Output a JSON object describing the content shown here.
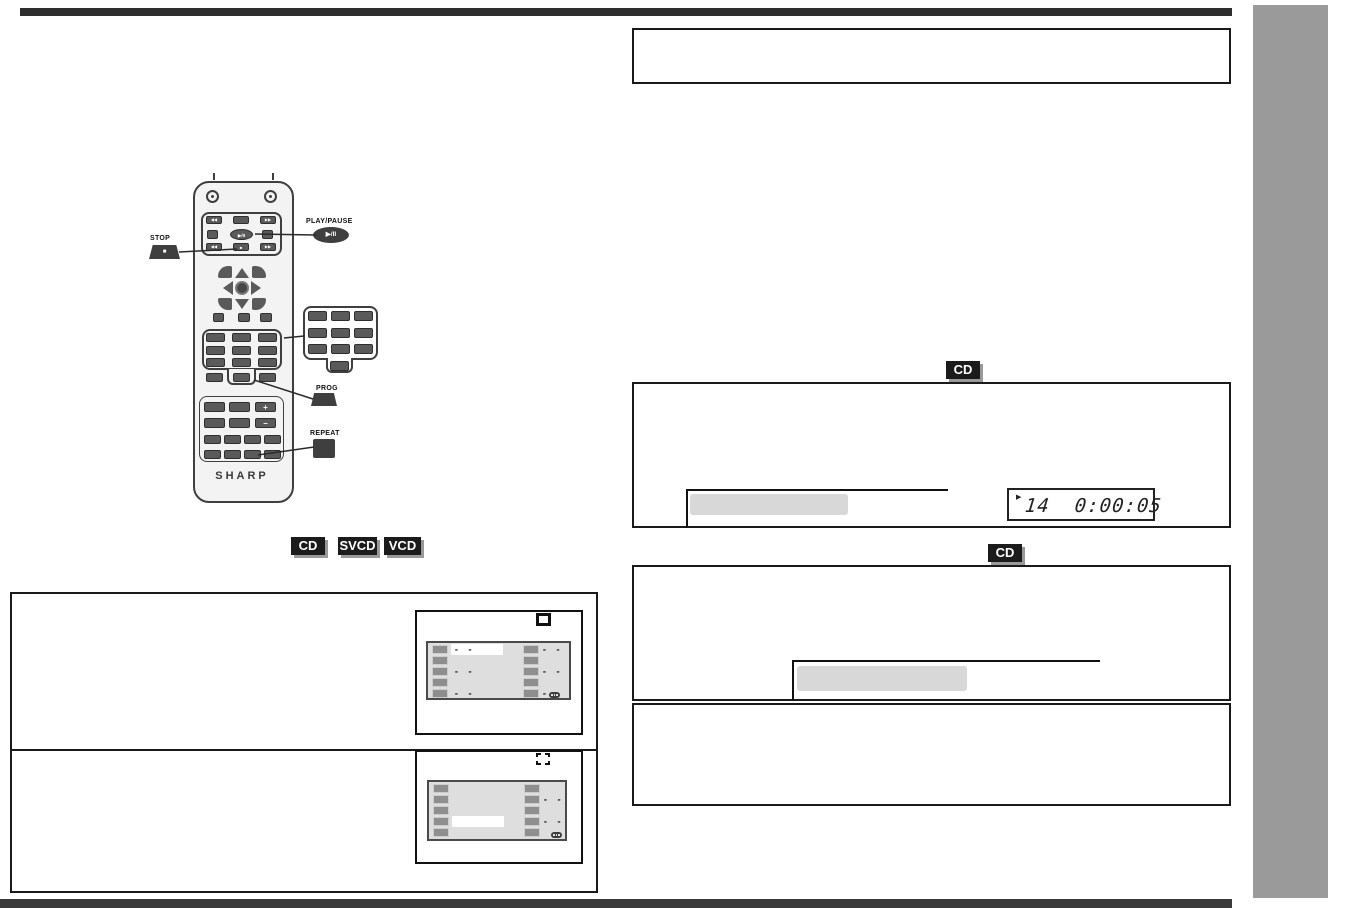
{
  "colors": {
    "sidebar": "#9a9a9a",
    "rule": "#2e2e2e",
    "badge_bg": "#1b1b1b",
    "badge_shadow": "#999999",
    "highlight_bar": "#d8d8d8",
    "key": "#5a5a5a"
  },
  "remote": {
    "brand": "SHARP",
    "stop_callout": {
      "label": "STOP",
      "key_glyph": "■"
    },
    "play_pause_callout": {
      "label": "PLAY/PAUSE",
      "key_glyph": "▶/II"
    },
    "prog_callout": {
      "label": "PROG"
    },
    "repeat_callout": {
      "label": "REPEAT"
    },
    "keys": {
      "prev": "◀◀",
      "next": "▶▶",
      "rew": "◀◀",
      "ff": "▶▶",
      "play_pause": "▶/II",
      "stop": "■",
      "plus": "+",
      "minus": "−"
    }
  },
  "media_badges": [
    "CD",
    "SVCD",
    "VCD"
  ],
  "right_column": {
    "section1_badge": "CD",
    "section2_badge": "CD",
    "display": {
      "status_icon": "▶",
      "track": "14",
      "time": "0:00:05"
    }
  },
  "screens": [
    {
      "rows": [
        {
          "left_dash": "- -",
          "left_highlight": true,
          "right_dash": "- -"
        },
        {
          "left_dash": "",
          "right_dash": ""
        },
        {
          "left_dash": "- -",
          "right_dash": "- -"
        },
        {
          "left_dash": "",
          "right_dash": ""
        },
        {
          "left_dash": "- -",
          "right_dash": "- -"
        }
      ]
    },
    {
      "rows": [
        {
          "left_dash": "",
          "right_dash": ""
        },
        {
          "left_dash": "",
          "right_dash": "- -"
        },
        {
          "left_dash": "",
          "right_dash": ""
        },
        {
          "left_dash": "",
          "left_highlight": true,
          "right_dash": "- -"
        },
        {
          "left_dash": "",
          "right_dash": ""
        }
      ]
    }
  ]
}
